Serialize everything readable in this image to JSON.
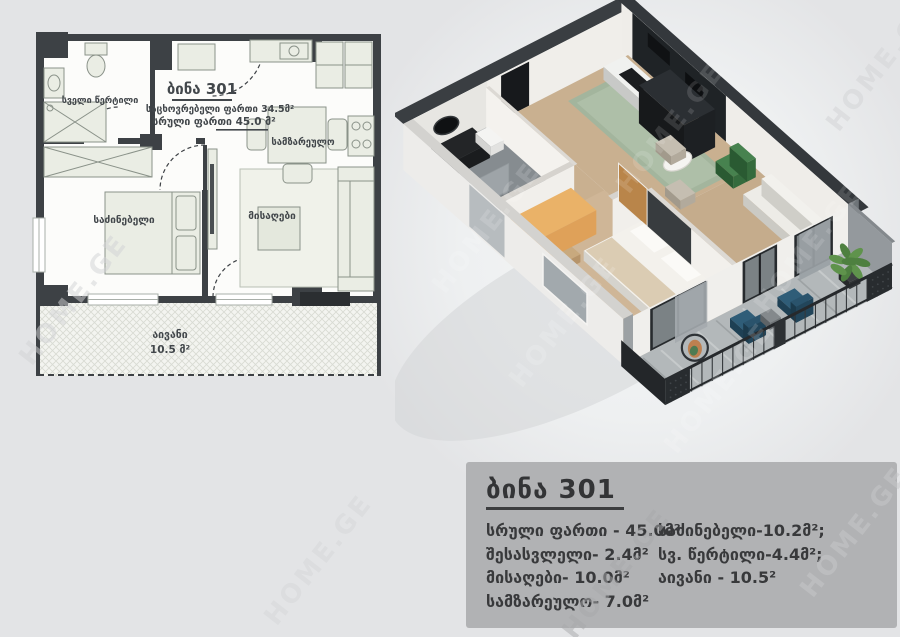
{
  "plan": {
    "title": "ბინა 301",
    "area_line1": "საცხოვრებელი ფართი 34.5მ²",
    "area_line2": "სრული ფართი  45.0 მ²",
    "labels": {
      "bathroom": "სველი წერტილი",
      "kitchen": "სამზარეულო",
      "bedroom": "საძინებელი",
      "living": "მისაღები",
      "balcony": "აივანი",
      "balcony_area": "10.5 მ²"
    }
  },
  "info_panel": {
    "title": "ბინა 301",
    "left_column": [
      "სრული ფართი - 45.0მ²",
      "შესასვლელი- 2.4მ²",
      "მისაღები- 10.0მ²",
      "სამზარეულო- 7.0მ²"
    ],
    "right_column": [
      "საძინებელი-10.2მ²;",
      "სვ. წერტილი-4.4მ²;",
      "აივანი - 10.5²"
    ]
  },
  "watermark": {
    "text": "HOME.GE"
  },
  "colors": {
    "page_bg": "#e3e4e6",
    "panel_bg": "#b1b2b4",
    "panel_text": "#38393b",
    "plan_wall": "#3d4145",
    "plan_furniture": "#eaede4",
    "wall_dark": "#3a3e42",
    "kitchen_black": "#1f2326",
    "floor_wood": "#c9b090",
    "floor_wood_light": "#cfb697",
    "rug_sage": "#a3b59d",
    "bathroom_floor": "#868c90",
    "balcony_floor": "#b3b8ba",
    "railing_dark": "#282c2f",
    "chair_blue": "#2f5d78",
    "chair_green": "#47824f",
    "wardrobe_orange": "#dfa159",
    "end_wall_gray": "#94999d",
    "plant_green": "#4e8040"
  }
}
